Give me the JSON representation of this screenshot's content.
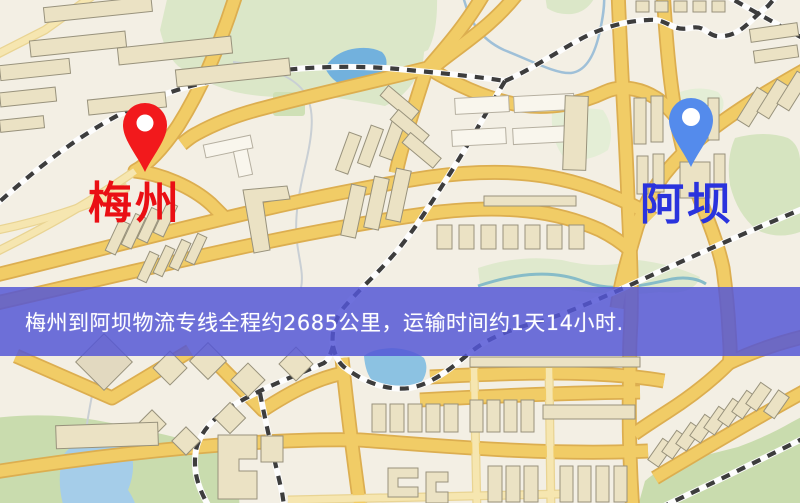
{
  "banner": {
    "text": "梅州到阿坝物流专线全程约2685公里，运输时间约1天14小时.",
    "background": "#5456d5",
    "text_color": "#ffffff"
  },
  "labels": {
    "origin": {
      "text": "梅州",
      "color": "#ea0f14"
    },
    "destination": {
      "text": "阿坝",
      "color": "#2a33dd"
    }
  },
  "pins": {
    "origin": {
      "name": "red-map-pin",
      "color": "#f2191c"
    },
    "destination": {
      "name": "blue-map-pin",
      "color": "#548bec"
    }
  },
  "map_palette": {
    "background": "#f3efe4",
    "road_major": "#f1cc66",
    "road_major_casing": "#dcae50",
    "road_minor": "#f6e6b0",
    "park": "#dbe7c8",
    "green_dark": "#c9dcae",
    "water": "#72b1dd",
    "railway_dash": "#3d3d3d",
    "building": "#ebe2c4"
  }
}
